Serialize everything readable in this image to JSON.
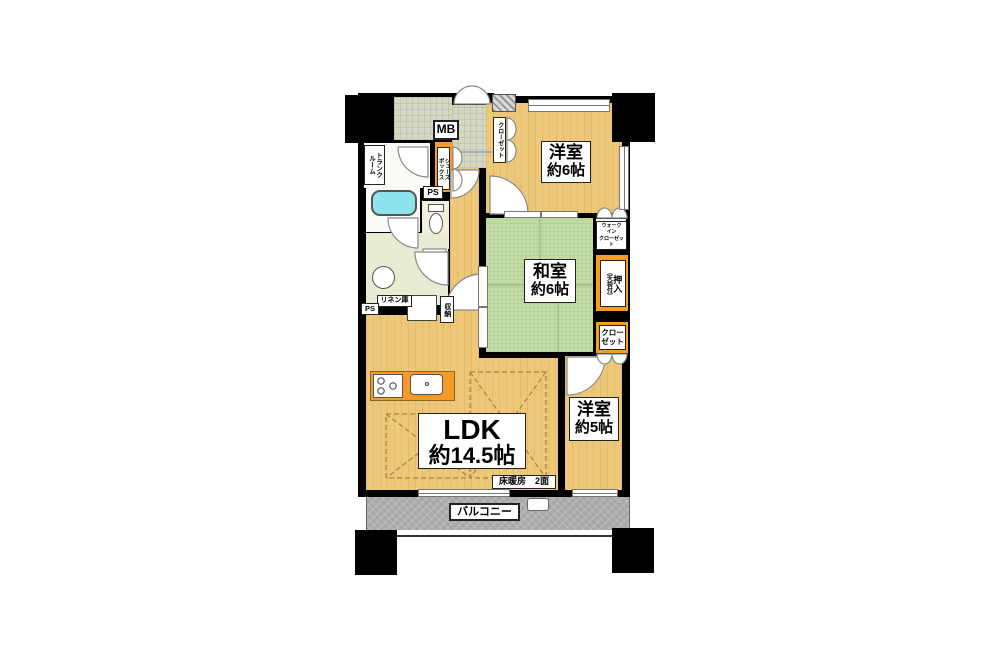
{
  "plan_title": "間取り図",
  "rooms": {
    "yoshitsu6": {
      "name": "洋室",
      "size": "約6帖"
    },
    "washitsu": {
      "name": "和室",
      "size": "約6帖"
    },
    "yoshitsu5": {
      "name": "洋室",
      "size": "約5帖"
    },
    "ldk": {
      "name": "LDK",
      "size": "約14.5帖"
    }
  },
  "labels": {
    "trunk_room": "トランク\nルーム",
    "mb": "MB",
    "shoes_box": "シューズ\nボックス",
    "ps_upper": "PS",
    "ps_lower": "PS",
    "closet_hall": "クローゼット",
    "walk_in_closet": "ウォーク\nイン\nクローゼット",
    "oshiire": "押入",
    "oshiire_note": "（天袋付）",
    "closet_5j": "クロー\nゼット",
    "linen": "リネン庫",
    "storage": "収納",
    "floor_heating": "床暖房　2面",
    "balcony": "バルコニー"
  },
  "colors": {
    "wall": "#000000",
    "wood_floor": "#ecc878",
    "tatami": "#c3dca6",
    "balcony": "#aeaeae",
    "closet_accent": "#f49b2a",
    "bathtub": "#8de4ee",
    "entry_tile": "#d4d7c2",
    "washroom": "#e9ecd2",
    "toilet_room": "#f1eedb"
  }
}
